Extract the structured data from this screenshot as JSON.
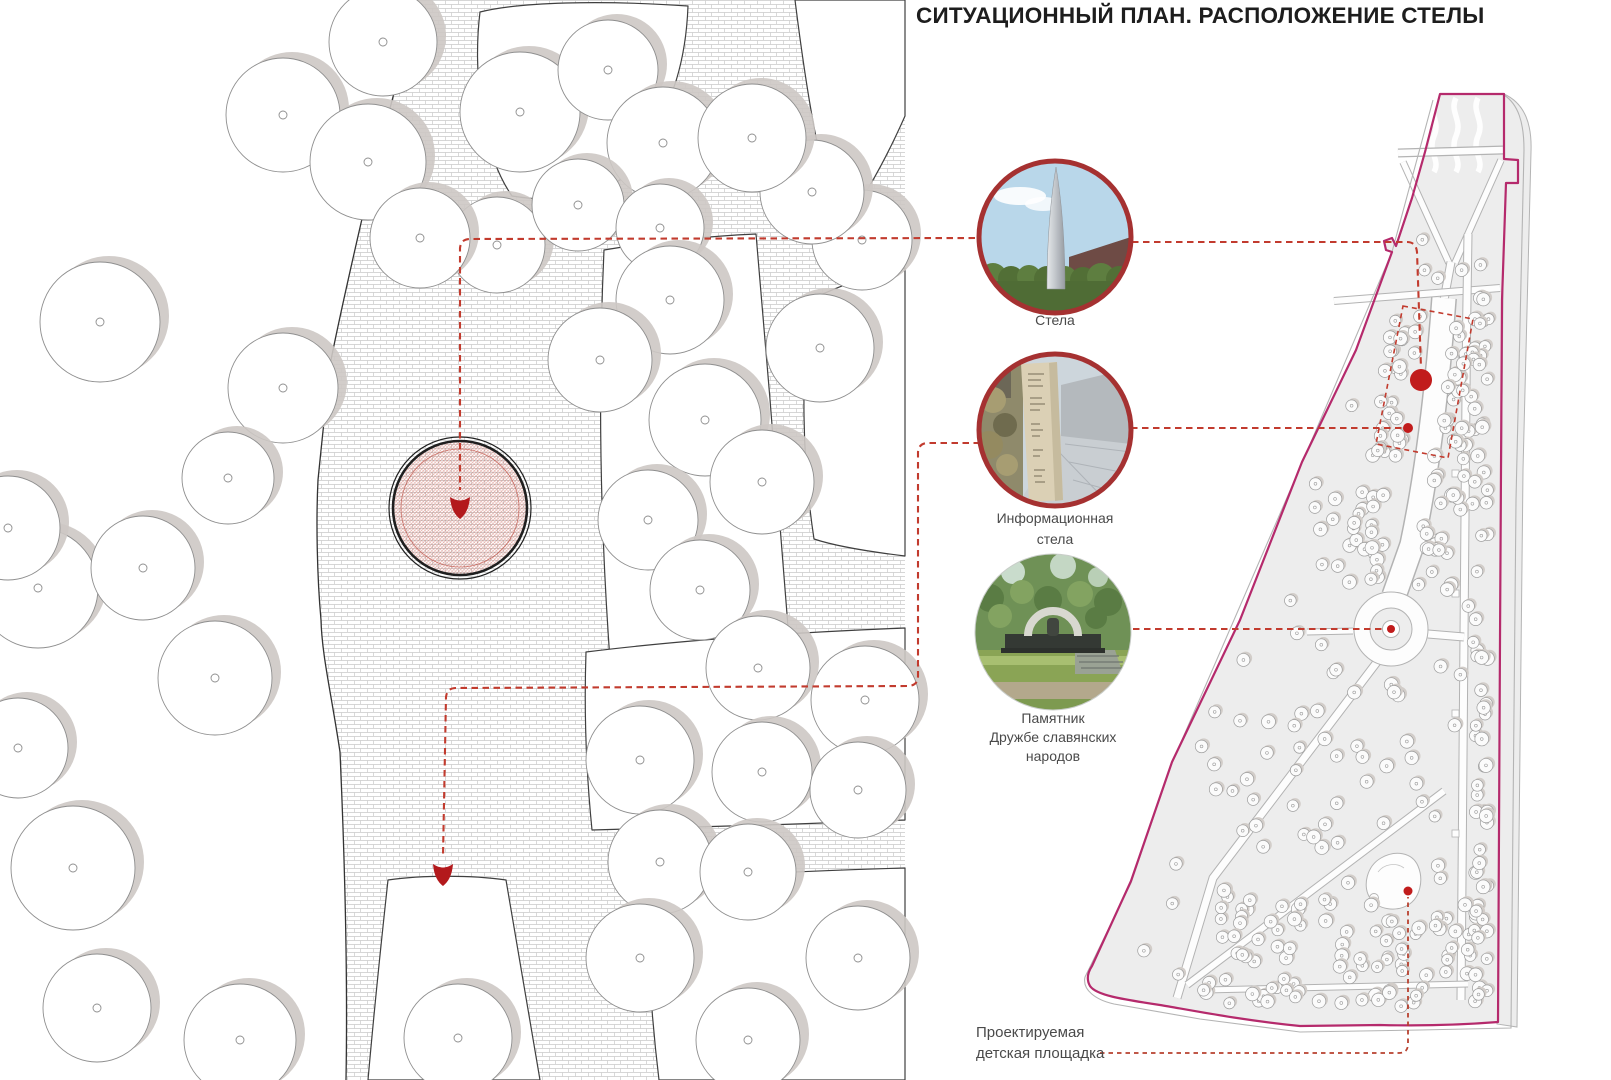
{
  "title": "СИТУАЦИОННЫЙ ПЛАН. РАСПОЛОЖЕНИЕ СТЕЛЫ",
  "legend": {
    "items": [
      {
        "id": "stela",
        "label": "Стела"
      },
      {
        "id": "info-stela",
        "label": "Информационная\nстела"
      },
      {
        "id": "monument",
        "label": "Памятник\nДружбе славянских\nнародов"
      },
      {
        "id": "playground",
        "label": "Проектируемая\nдетская площадка"
      }
    ]
  },
  "icons": {
    "stela_photo": "stela-spire-photo",
    "info_stela_photo": "information-stela-photo",
    "monument_photo": "friendship-monument-photo",
    "plan_marker": "stela-location-arrow",
    "map_markers": [
      "stela-dot",
      "info-stela-dot",
      "monument-dot",
      "playground-dot"
    ]
  },
  "colors": {
    "annotation_red": "#c23b2e",
    "marker_red": "#c11c1c",
    "arrow_red": "#b3191c",
    "photo_ring_red": "#a53131",
    "park_boundary_magenta": "#b52a6c",
    "park_fill": "#ededed",
    "path_casing": "#b3b3b3",
    "path_fill": "#fdfdfd",
    "brick_line": "#c9c9c9",
    "tree_shadow_big": "#cdc8c4",
    "tree_shadow_small": "#d2cdc9"
  }
}
